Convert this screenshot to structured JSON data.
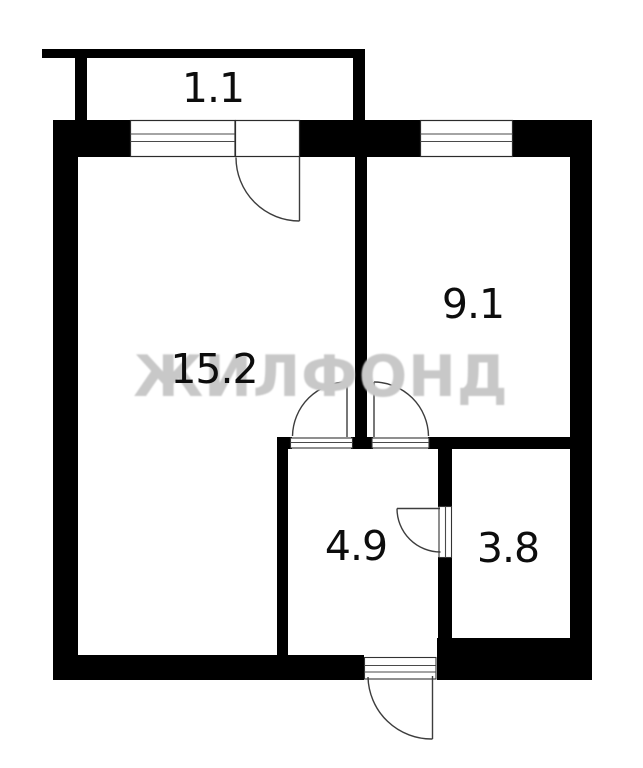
{
  "plan": {
    "watermark": "ЖИЛФОНД",
    "rooms": [
      {
        "area_label": "1.1"
      },
      {
        "area_label": "15.2"
      },
      {
        "area_label": "9.1"
      },
      {
        "area_label": "4.9"
      },
      {
        "area_label": "3.8"
      }
    ],
    "colors": {
      "background": "#ffffff",
      "wall": "#000000",
      "watermark": "#c8c8c8",
      "door_line": "#3d3d3d"
    }
  }
}
